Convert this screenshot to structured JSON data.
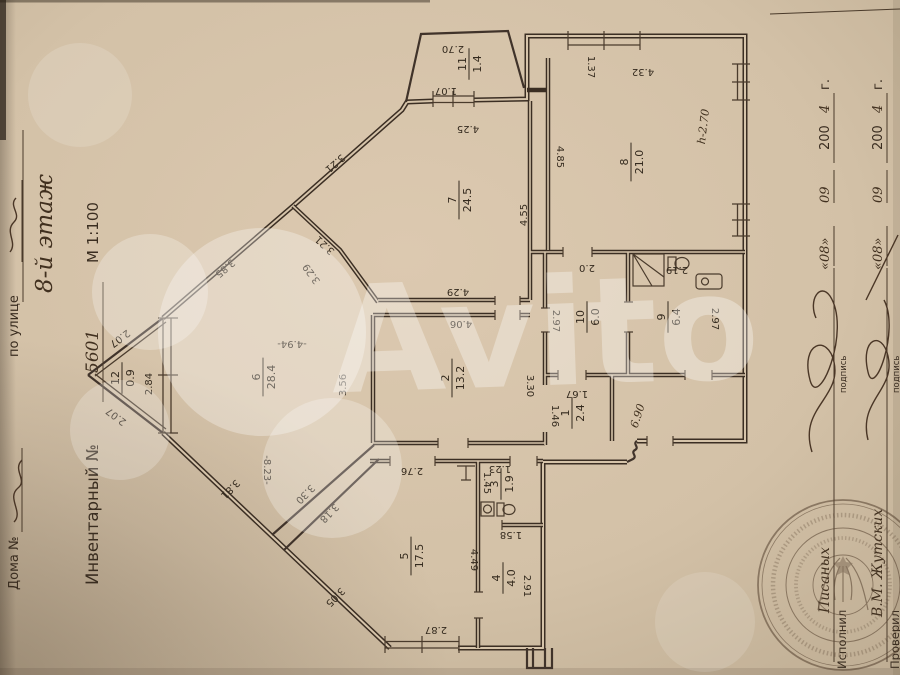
{
  "left_margin": {
    "house_label": "Дома №",
    "street_label": "по улице",
    "inventory_label": "Инвентарный №",
    "inventory_value": "5601",
    "scale": "М 1:100",
    "floor_note": "8-й этаж"
  },
  "right_margin": {
    "rows": [
      {
        "role": "Исполнил",
        "name": "Писаных",
        "sig_label": "подпись"
      },
      {
        "role": "Проверил",
        "name": "В.М. Жутских",
        "sig_label": "подпись"
      }
    ],
    "date": {
      "day": "«08»",
      "month": "09",
      "year": "200",
      "year_hand": "4",
      "suffix": "г."
    }
  },
  "watermark": {
    "text": "Avito"
  },
  "plan": {
    "rooms": [
      {
        "num": "12",
        "area": "0.9",
        "x": 122,
        "y": 378
      },
      {
        "num": "6",
        "area": "28.4",
        "x": 263,
        "y": 377
      },
      {
        "num": "5",
        "area": "17.5",
        "x": 411,
        "y": 556
      },
      {
        "num": "7",
        "area": "24.5",
        "x": 459,
        "y": 200
      },
      {
        "num": "11",
        "area": "1.4",
        "x": 469,
        "y": 64
      },
      {
        "num": "8",
        "area": "21.0",
        "x": 631,
        "y": 162
      },
      {
        "num": "2",
        "area": "13.2",
        "x": 452,
        "y": 378
      },
      {
        "num": "10",
        "area": "6.0",
        "x": 587,
        "y": 317
      },
      {
        "num": "9",
        "area": "6.4",
        "x": 668,
        "y": 317
      },
      {
        "num": "1",
        "area": "2.4",
        "x": 572,
        "y": 413
      },
      {
        "num": "3",
        "area": "1.9",
        "x": 501,
        "y": 484
      },
      {
        "num": "4",
        "area": "4.0",
        "x": 503,
        "y": 578
      }
    ],
    "dims": [
      {
        "t": "2.07",
        "x": 118,
        "y": 336,
        "r": 143
      },
      {
        "t": "2.07",
        "x": 118,
        "y": 414,
        "r": -143
      },
      {
        "t": "2.84",
        "x": 152,
        "y": 384,
        "r": -90
      },
      {
        "t": "3.85",
        "x": 223,
        "y": 266,
        "r": 139
      },
      {
        "t": "3.21",
        "x": 333,
        "y": 161,
        "r": 139
      },
      {
        "t": "3.21",
        "x": 327,
        "y": 243,
        "r": -137
      },
      {
        "t": "3.29",
        "x": 314,
        "y": 272,
        "r": -126
      },
      {
        "t": "-4.94-",
        "x": 292,
        "y": 341,
        "r": 180
      },
      {
        "t": "-8.23-",
        "x": 264,
        "y": 470,
        "r": 90
      },
      {
        "t": "3.30",
        "x": 303,
        "y": 492,
        "r": 134
      },
      {
        "t": "3.18",
        "x": 327,
        "y": 511,
        "r": 134
      },
      {
        "t": "3.81",
        "x": 228,
        "y": 487,
        "r": 134
      },
      {
        "t": "3.05",
        "x": 333,
        "y": 595,
        "r": 134
      },
      {
        "t": "3.56",
        "x": 346,
        "y": 385,
        "r": -90
      },
      {
        "t": "4.29",
        "x": 458,
        "y": 289,
        "r": 180
      },
      {
        "t": "4.06",
        "x": 461,
        "y": 321,
        "r": 180
      },
      {
        "t": "4.55",
        "x": 527,
        "y": 215,
        "r": -90
      },
      {
        "t": "4.25",
        "x": 468,
        "y": 126,
        "r": 180
      },
      {
        "t": "1.07",
        "x": 446,
        "y": 88,
        "r": 180
      },
      {
        "t": "2.70",
        "x": 453,
        "y": 46,
        "r": 180
      },
      {
        "t": "1.37",
        "x": 588,
        "y": 67,
        "r": 90
      },
      {
        "t": "4.32",
        "x": 643,
        "y": 69,
        "r": 180
      },
      {
        "t": "4.85",
        "x": 557,
        "y": 157,
        "r": 90
      },
      {
        "t": "2.0",
        "x": 587,
        "y": 265,
        "r": 180
      },
      {
        "t": "2.97",
        "x": 553,
        "y": 321,
        "r": 90
      },
      {
        "t": "2.97",
        "x": 712,
        "y": 319,
        "r": 90
      },
      {
        "t": "3.30",
        "x": 527,
        "y": 386,
        "r": 90
      },
      {
        "t": "2.19",
        "x": 677,
        "y": 267,
        "r": 180
      },
      {
        "t": "1.67",
        "x": 577,
        "y": 391,
        "r": 180
      },
      {
        "t": "1.46",
        "x": 552,
        "y": 416,
        "r": 90
      },
      {
        "t": "2.76",
        "x": 412,
        "y": 468,
        "r": 180
      },
      {
        "t": "2.87",
        "x": 436,
        "y": 627,
        "r": 180
      },
      {
        "t": "4.49",
        "x": 471,
        "y": 560,
        "r": 90
      },
      {
        "t": "2.91",
        "x": 524,
        "y": 586,
        "r": 90
      },
      {
        "t": "1.58",
        "x": 511,
        "y": 532,
        "r": 180
      },
      {
        "t": "1.45",
        "x": 484,
        "y": 483,
        "r": 90
      },
      {
        "t": "1.23",
        "x": 500,
        "y": 466,
        "r": 180
      }
    ],
    "notes": [
      {
        "t": "h-2.70",
        "x": 707,
        "y": 127,
        "r": -83
      },
      {
        "t": "6.90",
        "x": 641,
        "y": 417,
        "r": -72
      }
    ]
  }
}
